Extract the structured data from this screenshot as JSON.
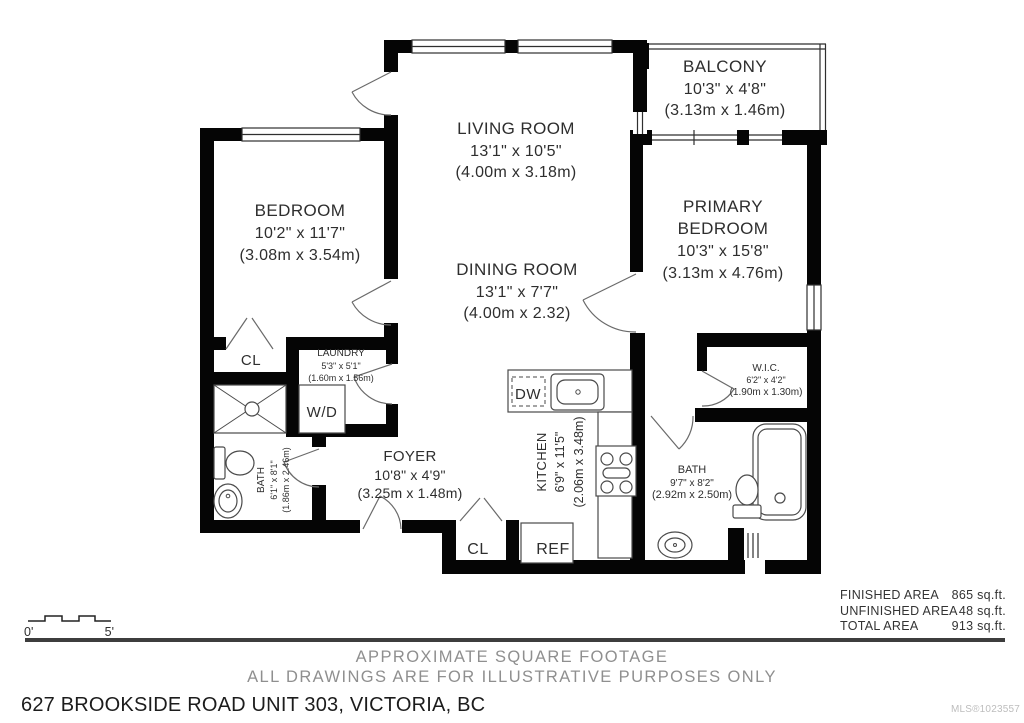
{
  "plan": {
    "rooms": {
      "living": {
        "name": "LIVING ROOM",
        "imperial": "13'1\" x 10'5\"",
        "metric": "(4.00m x 3.18m)"
      },
      "dining": {
        "name": "DINING ROOM",
        "imperial": "13'1\" x 7'7\"",
        "metric": "(4.00m x 2.32)"
      },
      "bedroom": {
        "name": "BEDROOM",
        "imperial": "10'2\" x 11'7\"",
        "metric": "(3.08m x 3.54m)"
      },
      "primary": {
        "name_line1": "PRIMARY",
        "name_line2": "BEDROOM",
        "imperial": "10'3\" x 15'8\"",
        "metric": "(3.13m x 4.76m)"
      },
      "balcony": {
        "name": "BALCONY",
        "imperial": "10'3\" x 4'8\"",
        "metric": "(3.13m x 1.46m)"
      },
      "foyer": {
        "name": "FOYER",
        "imperial": "10'8\" x 4'9\"",
        "metric": "(3.25m x 1.48m)"
      },
      "kitchen": {
        "name": "KITCHEN",
        "imperial": "6'9\" x 11'5\"",
        "metric": "(2.06m x 3.48m)"
      },
      "laundry": {
        "name": "LAUNDRY",
        "imperial": "5'3\" x 5'1\"",
        "metric": "(1.60m x 1.56m)"
      },
      "wic": {
        "name": "W.I.C.",
        "imperial": "6'2\" x 4'2\"",
        "metric": "(1.90m x 1.30m)"
      },
      "bath_main": {
        "name": "BATH",
        "imperial": "6'1\" x 8'1\"",
        "metric": "(1.86m x 2.46m)"
      },
      "bath_ensuite": {
        "name": "BATH",
        "imperial": "9'7\" x 8'2\"",
        "metric": "(2.92m x 2.50m)"
      }
    },
    "fixtures": {
      "closet1": "CL",
      "closet2": "CL",
      "fridge": "REF",
      "dishwasher": "DW",
      "washer_dryer": "W/D"
    },
    "scale": {
      "start": "0'",
      "end": "5'"
    }
  },
  "areas": {
    "finished": {
      "label": "FINISHED AREA",
      "value": "865 sq.ft."
    },
    "unfinished": {
      "label": "UNFINISHED AREA",
      "value": "48 sq.ft."
    },
    "total": {
      "label": "TOTAL AREA",
      "value": "913 sq.ft."
    }
  },
  "footer": {
    "disclaimer_line1": "APPROXIMATE SQUARE FOOTAGE",
    "disclaimer_line2": "ALL DRAWINGS ARE FOR ILLUSTRATIVE PURPOSES ONLY",
    "address": "627 BROOKSIDE ROAD UNIT 303, VICTORIA, BC",
    "mls": "MLS®1023557"
  },
  "colors": {
    "wall": "#000000",
    "text": "#2e2e2e",
    "disclaimer": "#8f8f8f",
    "mls": "#bdbdbd"
  }
}
